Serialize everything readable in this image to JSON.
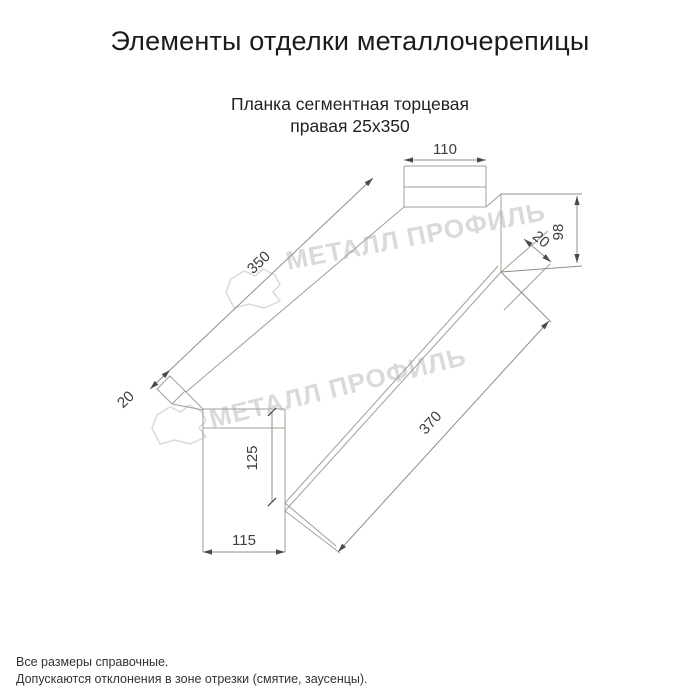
{
  "page": {
    "title": "Элементы отделки металлочерепицы",
    "subtitle_line1": "Планка сегментная торцевая",
    "subtitle_line2": "правая 25х350",
    "footer_line1": "Все размеры справочные.",
    "footer_line2": "Допускаются отклонения в зоне отрезки (смятие, заусенцы)."
  },
  "drawing": {
    "product_name": "Планка сегментная торцевая правая 25х350",
    "dimensions": {
      "top_width": "110",
      "face_length": "350",
      "left_lip": "20",
      "right_height": "98",
      "right_lip": "20",
      "left_face_height": "125",
      "bottom_width": "115",
      "total_length": "370"
    },
    "watermark": {
      "text": "МЕТАЛЛ ПРОФИЛЬ",
      "logo": "metall-profil-crystal-logo"
    },
    "colors": {
      "background": "#ffffff",
      "drawing_line": "#a69d96",
      "dimension_text": "#3d3d3d",
      "title_text": "#1b1b1b",
      "watermark": "#dadada"
    }
  }
}
